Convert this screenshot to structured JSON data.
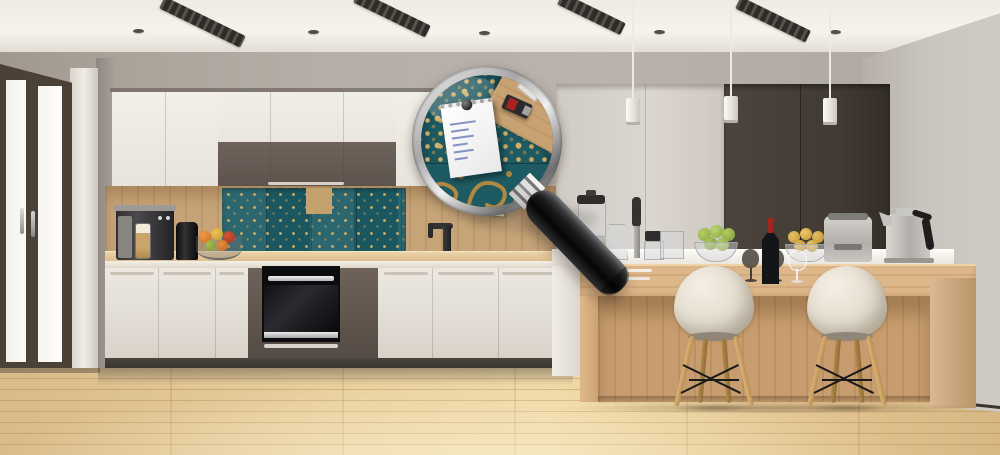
{
  "scene": {
    "title": "Modern kitchen with magnifying glass revealing backsplash detail",
    "description": "Photorealistic render of a modern white-and-brown kitchen: French window at left, teal patchwork tile backsplash with gold ornament, black built-in oven, wooden island bar with two white shell chairs, stainless appliances, three pendant lights, and a large magnifying glass overlay showing a close-up of the tile with a pinned handwritten note.",
    "counts": {
      "ceiling_vents": 4,
      "recessed_spots": 5,
      "pendant_lights": 3,
      "chairs": 2,
      "window_panes": 2,
      "note_scribble_lines": 6
    },
    "objects": [
      "french-window",
      "window-handles",
      "upper-cabinets-white",
      "upper-cabinets-brown",
      "teal-gold-tile-backsplash",
      "wood-plank-wall",
      "pinned-note",
      "usb-drive-on-wall",
      "black-faucet",
      "espresso-machine",
      "latte-glass",
      "black-canister",
      "wire-fruit-bowl",
      "built-in-oven",
      "oven-drawer",
      "tall-grey-cabinets",
      "dark-brown-wall-panels",
      "island-white-counter",
      "wooden-bar-counter",
      "blender",
      "measuring-jug",
      "stick-blender",
      "chopper-accessories",
      "glass-container",
      "bowl-of-green-apples",
      "bowl-of-yellow-fruit",
      "smoked-wine-glasses",
      "wine-bottle",
      "clear-wine-glass",
      "toaster",
      "kettle",
      "eames-style-chairs",
      "pendant-lights",
      "ceiling-vents",
      "recessed-spots",
      "magnifying-glass",
      "magnified-tile-pattern",
      "magnified-gold-swirls",
      "magnified-note-with-pin",
      "magnified-usb-drive",
      "magnified-gum-sticks",
      "wood-floor"
    ]
  },
  "palette": {
    "ceiling": "#f2efe8",
    "wall_left": "#a59c93",
    "wall_back": "#b5ada4",
    "wall_right": "#c9c4be",
    "window_frame": "#4c4136",
    "cabinet_white": "#efebe4",
    "cabinet_brown": "#675c54",
    "tall_cabinet_grey": "#d6d1ca",
    "panel_dark_brown": "#463e38",
    "tile_teal": "#215f68",
    "tile_gold": "#c59a55",
    "wood_wall": "#c6a478",
    "counter_wood": "#ddbd92",
    "island_wood": "#cfa577",
    "floor_wood": "#e8cd9c",
    "chair_shell": "#ece5d8",
    "chair_legs": "#c69e5f",
    "appliance_steel": "#c9c7c2",
    "oven_black": "#0d0d0f",
    "magnifier_handle": "#141416",
    "magnifier_rim": "#bfbfbf",
    "note_paper": "#f6f5f2",
    "note_ink": "#7080b8",
    "wine_capsule": "#a02622",
    "apple_green": "#a3bf55",
    "fruit_yellow": "#d9ae4f"
  }
}
